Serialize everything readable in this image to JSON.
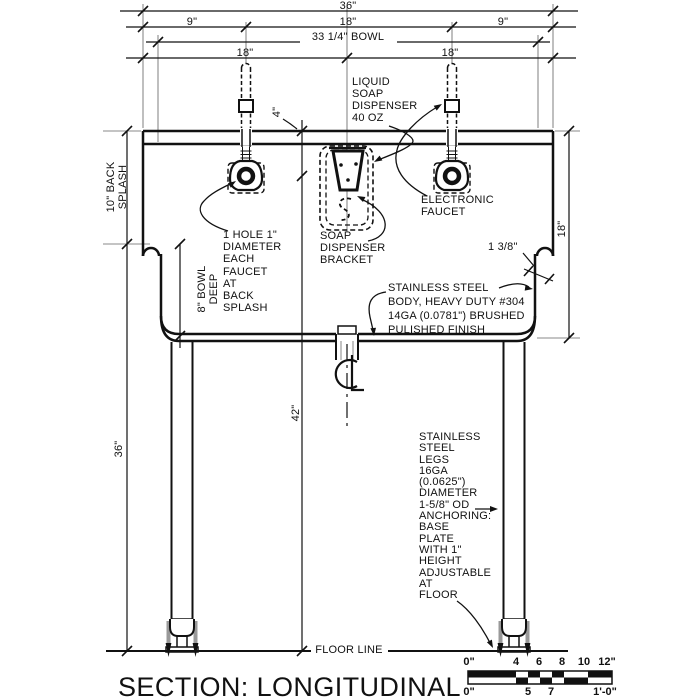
{
  "title": "SECTION: LONGITUDINAL",
  "dimensions": {
    "overall_width": "36\"",
    "left_offset": "9\"",
    "faucet_spacing": "18\"",
    "right_offset": "9\"",
    "bowl_width": "33 1/4\" BOWL",
    "edge_to_center_left": "18\"",
    "edge_to_center_right": "18\"",
    "back_splash": "10\" BACK\nSPLASH",
    "bowl_depth": "8\" BOWL\nDEEP",
    "rim_height": "36\"",
    "dispenser_height": "42\"",
    "faucet_drop": "4\"",
    "body_height": "18\"",
    "rim_roll": "1 3/8\""
  },
  "callouts": {
    "soap_dispenser": "LIQUID\nSOAP\nDISPENSER\n40 OZ",
    "dispenser_bracket": "SOAP\nDISPENSER\nBRACKET",
    "electronic_faucet": "ELECTRONIC\nFAUCET",
    "faucet_hole": "1 HOLE 1\"\nDIAMETER\nEACH\nFAUCET\nAT\nBACK\nSPLASH",
    "body_spec": "STAINLESS STEEL\nBODY, HEAVY DUTY #304\n14GA (0.0781\") BRUSHED\nPULISHED FINISH",
    "legs_spec": "STAINLESS\nSTEEL\nLEGS\n16GA\n(0.0625\")\nDIAMETER\n1-5/8\" OD\nANCHORING:\nBASE\nPLATE\nWITH 1\"\nHEIGHT\nADJUSTABLE\nAT\nFLOOR",
    "floor_line": "FLOOR LINE"
  },
  "scale_bar": {
    "top": [
      "0\"",
      "4",
      "6",
      "8",
      "10",
      "12\""
    ],
    "bottom": [
      "0\"",
      "5",
      "7",
      "1'-0\""
    ]
  },
  "colors": {
    "line": "#111111",
    "extension": "#8a8a8a",
    "hardware": "#999999",
    "background": "#ffffff"
  }
}
